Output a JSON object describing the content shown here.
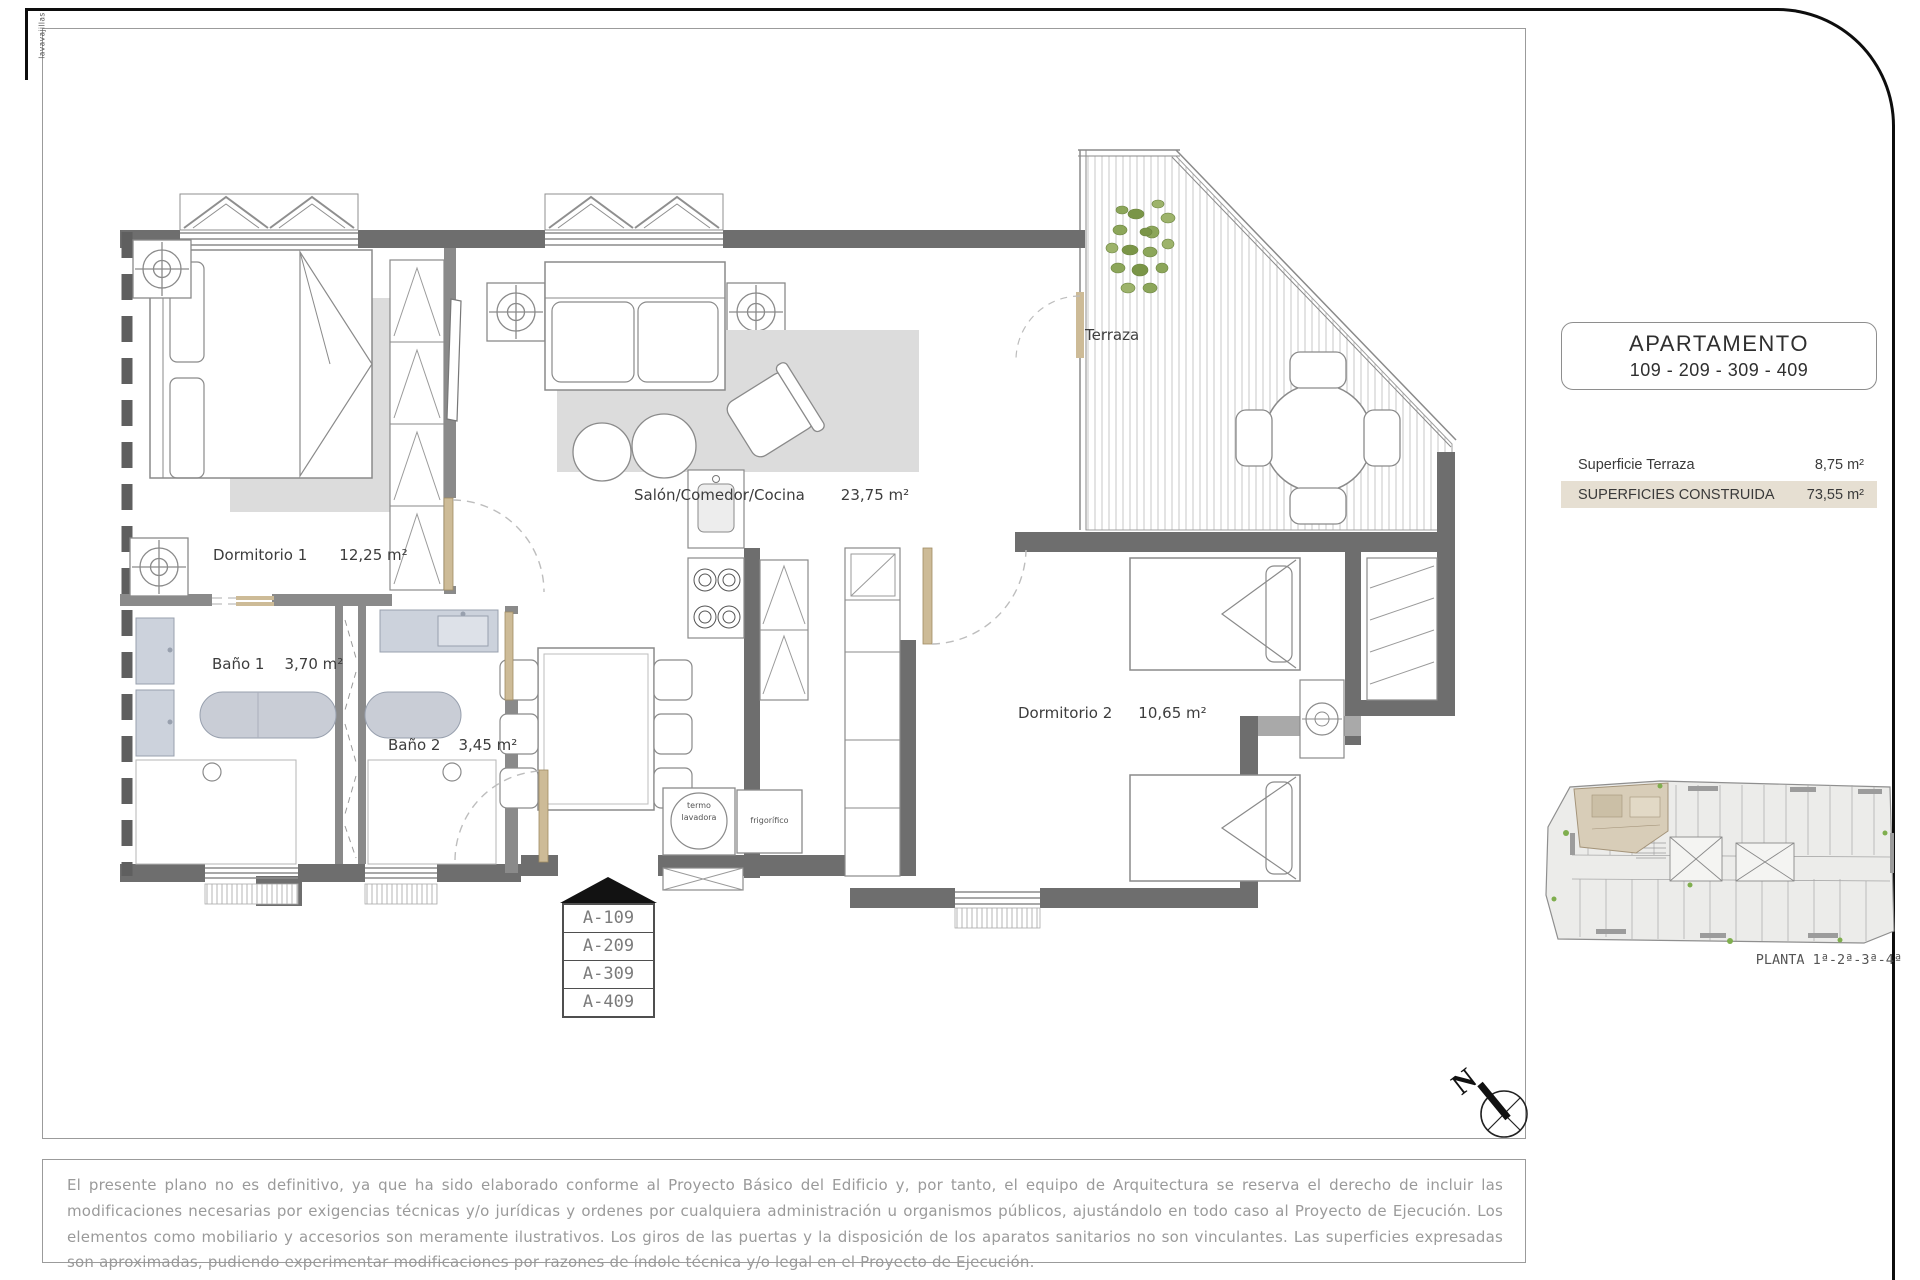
{
  "sheet": {
    "title_box": {
      "line1": "APARTAMENTO",
      "line2": "109 - 209 - 309 - 409"
    },
    "areas": {
      "terraza_label": "Superficie Terraza",
      "terraza_value": "8,75 m²",
      "construida_label": "SUPERFICIES CONSTRUIDA",
      "construida_value": "73,55 m²"
    },
    "key_plan_caption": "PLANTA 1ª-2ª-3ª-4ª",
    "north_label": "N",
    "disclaimer": "El presente plano no es definitivo, ya que ha sido elaborado conforme al Proyecto Básico del Edificio y, por tanto, el equipo de Arquitectura se reserva el derecho de incluir las modificaciones necesarias por exigencias técnicas y/o jurídicas y ordenes por cualquiera administración u organismos públicos, ajustándolo en todo caso al Proyecto de Ejecución. Los elementos como mobiliario y accesorios son meramente ilustrativos. Los giros de las puertas y la disposición de los aparatos sanitarios no son vinculantes. Las superficies expresadas son aproximadas, pudiendo experimentar modificaciones por razones de índole técnica y/o legal en el Proyecto de Ejecución."
  },
  "plan": {
    "rooms": [
      {
        "name": "Dormitorio 1",
        "area": "12,25 m²"
      },
      {
        "name": "Baño 1",
        "area": "3,70 m²"
      },
      {
        "name": "Baño 2",
        "area": "3,45 m²"
      },
      {
        "name": "Salón/Comedor/Cocina",
        "area": "23,75 m²"
      },
      {
        "name": "Dormitorio 2",
        "area": "10,65 m²"
      },
      {
        "name": "Terraza",
        "area": ""
      }
    ],
    "appliances": {
      "washer_line1": "termo",
      "washer_line2": "lavadora",
      "fridge": "frigorífico",
      "dishwasher": "lavavajillas"
    },
    "unit_stack": [
      "A-109",
      "A-209",
      "A-309",
      "A-409"
    ],
    "colors": {
      "exterior_wall": "#6e6e6e",
      "interior_wall": "#8a8a8a",
      "highlight_beige": "#e6dfd2",
      "door_tan": "#cdbb97",
      "plant_green": "#7fae4e"
    }
  }
}
